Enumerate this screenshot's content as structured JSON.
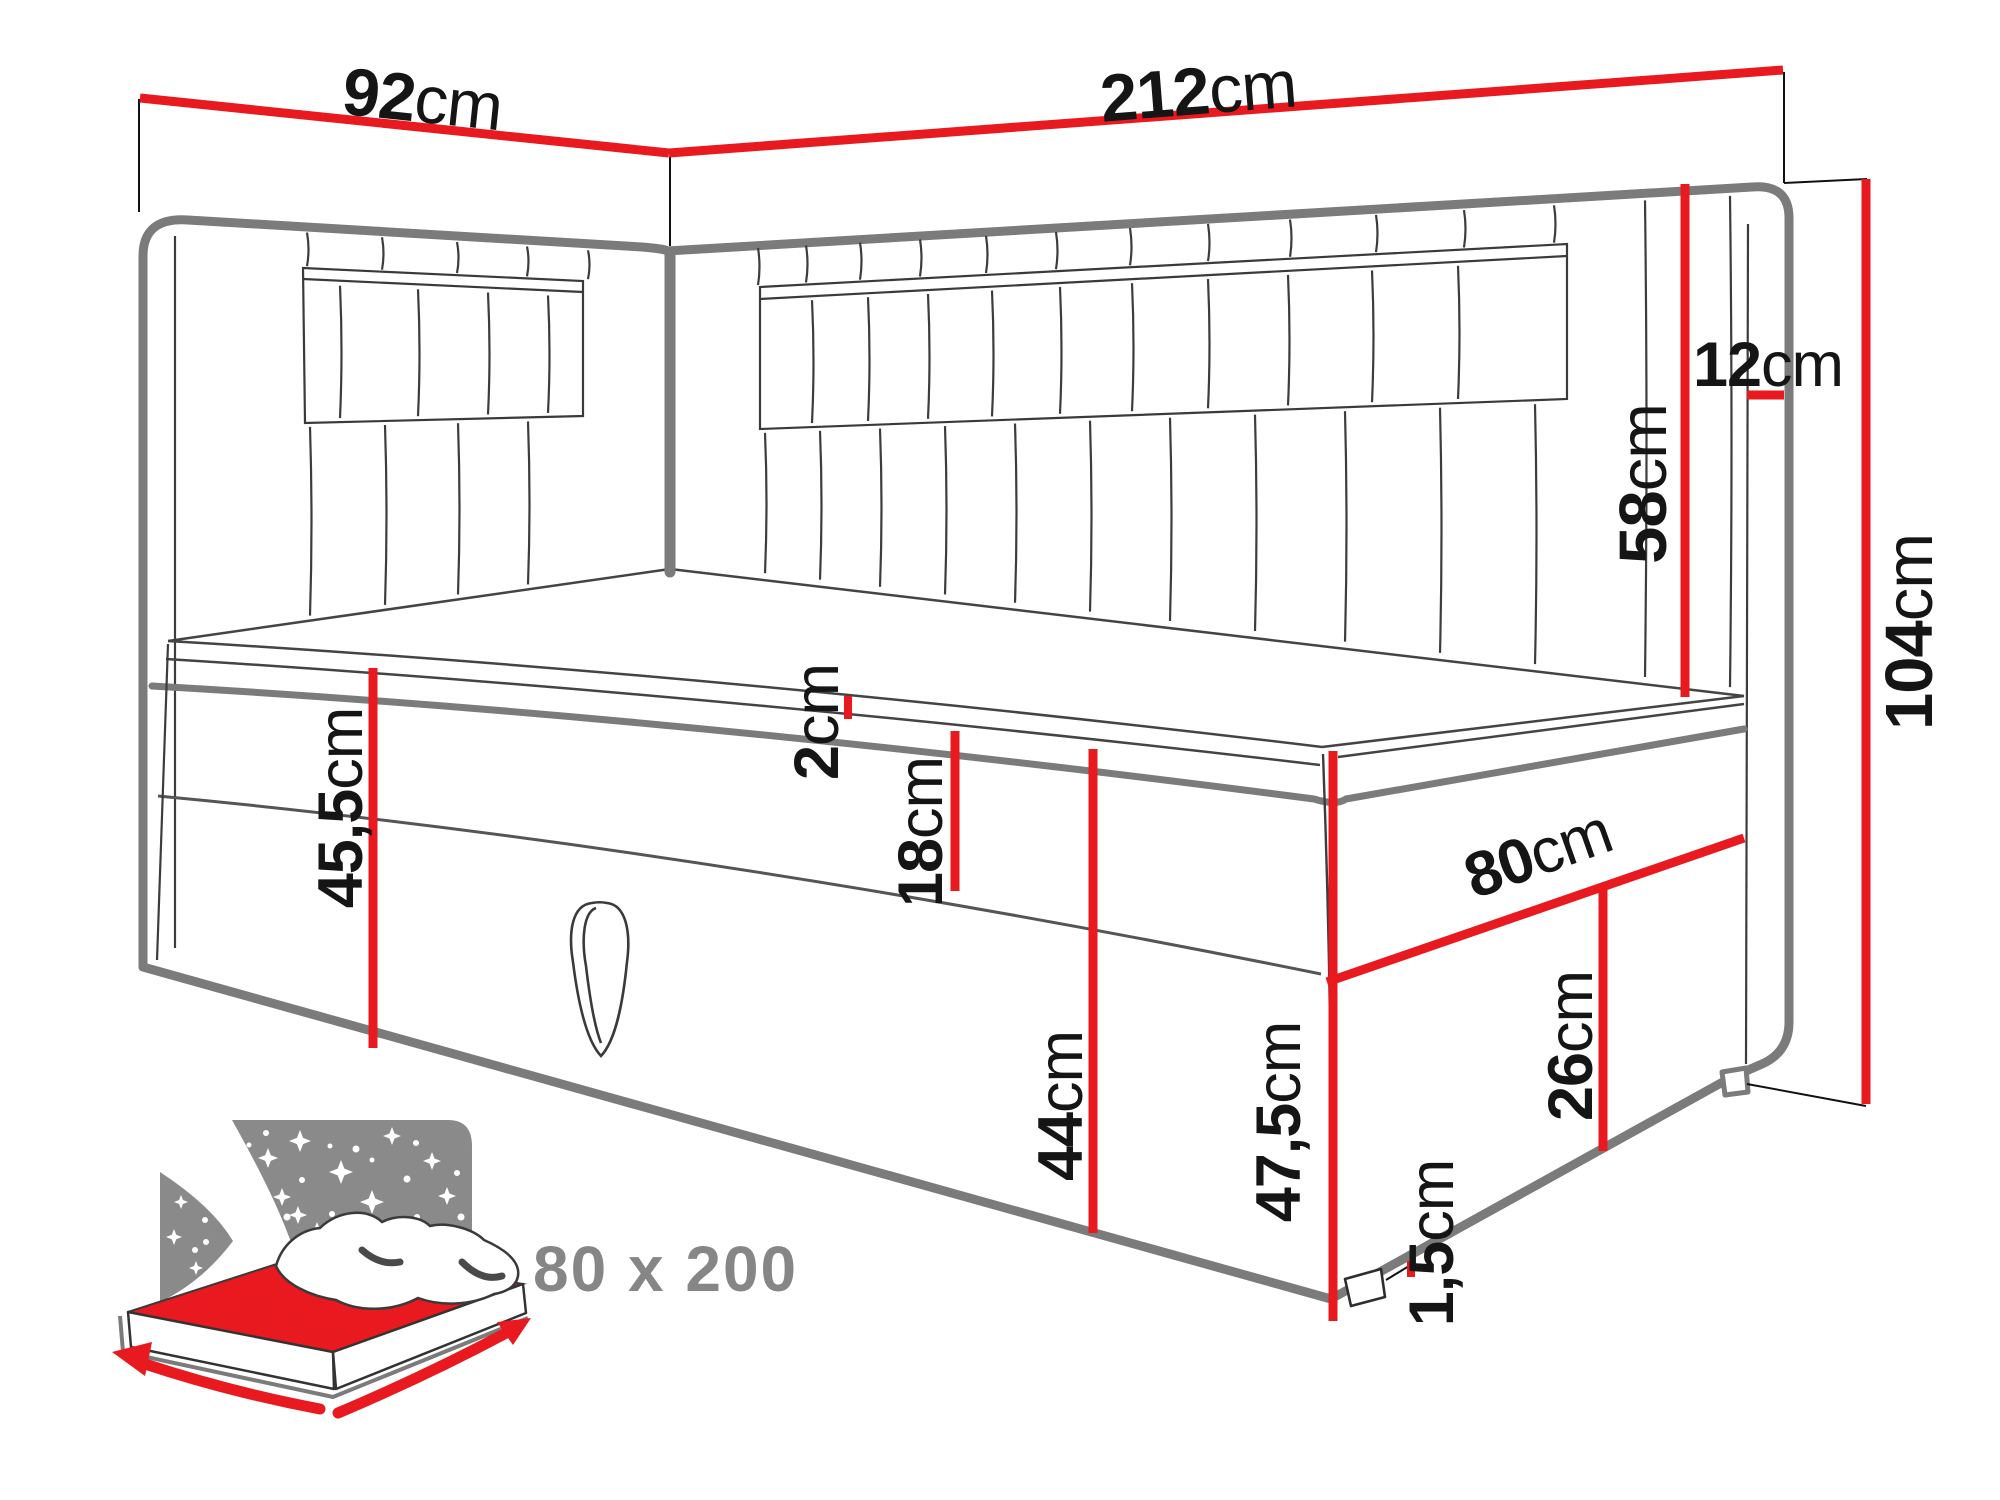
{
  "diagram": {
    "type": "bed-dimension-diagram",
    "unit": "cm",
    "dims": {
      "d92": {
        "value": "92",
        "unit": "cm"
      },
      "d212": {
        "value": "212",
        "unit": "cm"
      },
      "d12": {
        "value": "12",
        "unit": "cm"
      },
      "d58": {
        "value": "58",
        "unit": "cm"
      },
      "d104": {
        "value": "104",
        "unit": "cm"
      },
      "d2": {
        "value": "2",
        "unit": "cm"
      },
      "d18": {
        "value": "18",
        "unit": "cm"
      },
      "d45_5": {
        "value": "45,5",
        "unit": "cm"
      },
      "d44": {
        "value": "44",
        "unit": "cm"
      },
      "d80": {
        "value": "80",
        "unit": "cm"
      },
      "d26": {
        "value": "26",
        "unit": "cm"
      },
      "d47_5": {
        "value": "47,5",
        "unit": "cm"
      },
      "d1_5": {
        "value": "1,5",
        "unit": "cm"
      }
    },
    "icon": {
      "label": "80 x 200"
    },
    "colors": {
      "dimension_red": "#e8191f",
      "outline_gray": "#7b7b7b",
      "icon_gray": "#8a8a8a",
      "label_black": "#151515",
      "icon_text_gray": "#868686"
    }
  }
}
